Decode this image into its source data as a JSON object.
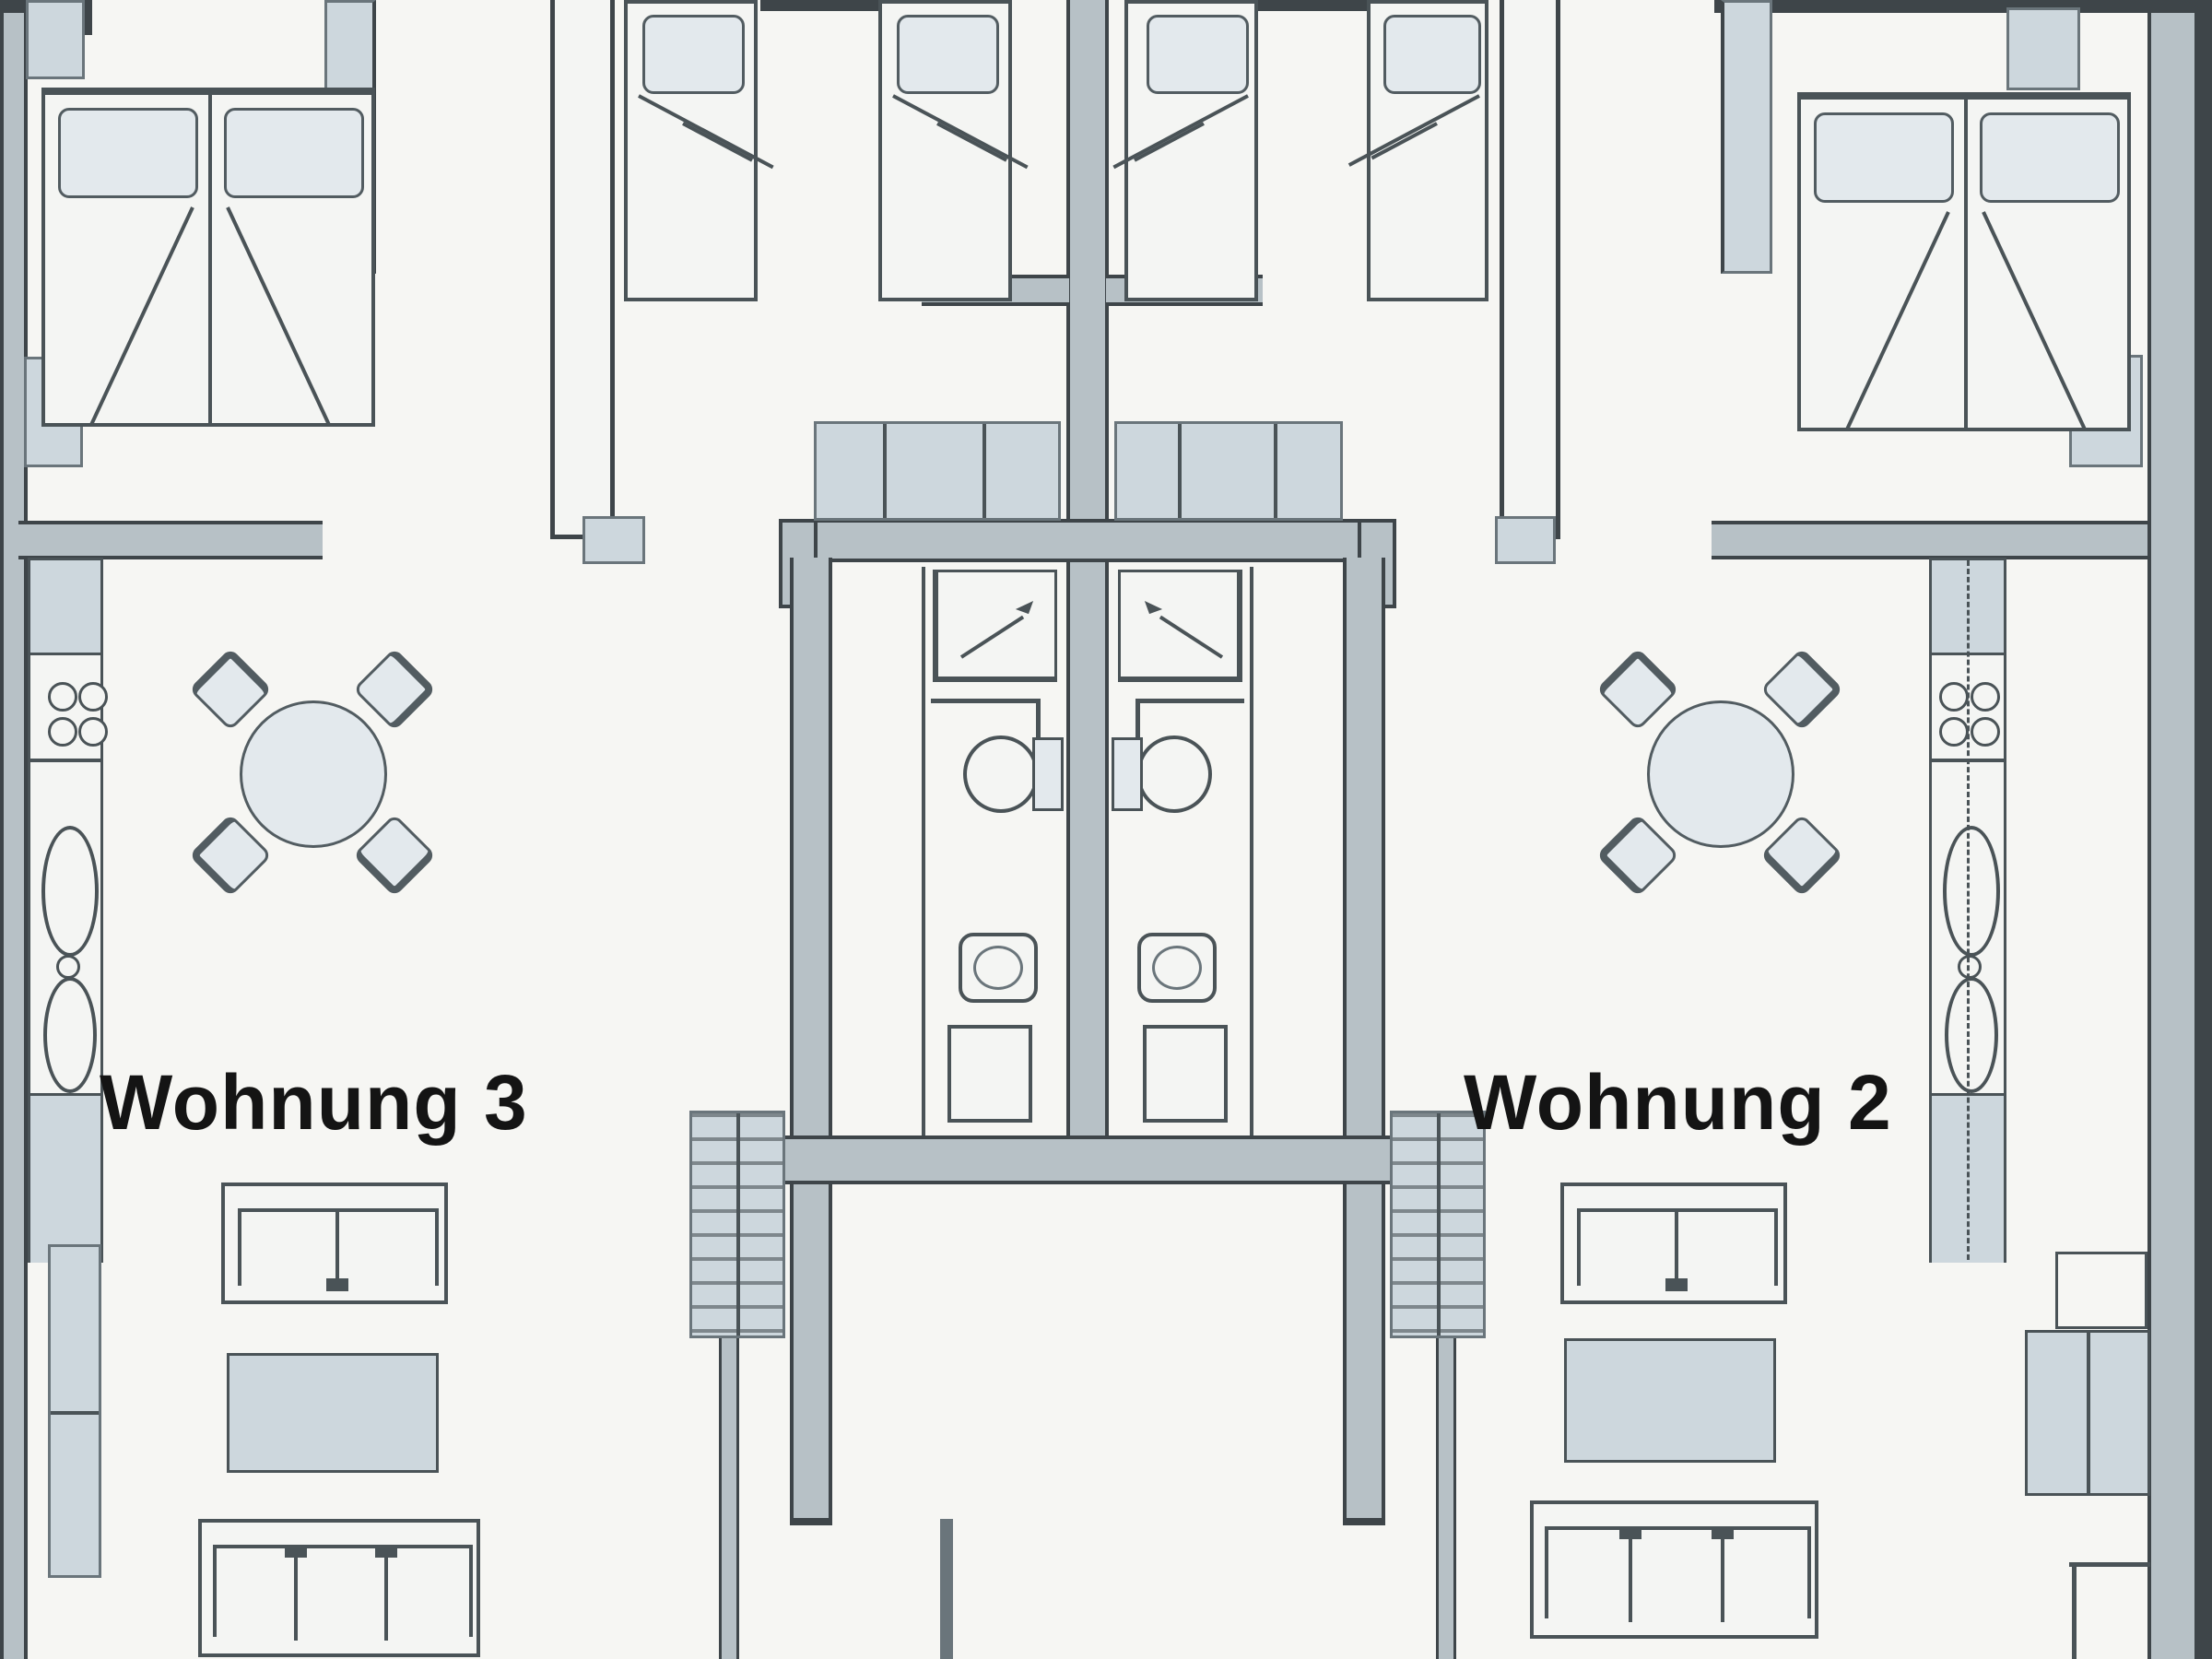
{
  "title": "Apartment floor plan",
  "apartments": [
    {
      "id": "wohnung-3",
      "label": "Wohnung 3"
    },
    {
      "id": "wohnung-2",
      "label": "Wohnung 2"
    }
  ],
  "colors": {
    "bg": "#f6f6f3",
    "white": "#f4f5f3",
    "wall_fill": "#b7c1c6",
    "wall_edge": "#3e4549",
    "line": "#4a5357",
    "furn_fill": "#e3e9ed",
    "furn_edge": "#525c61",
    "shade_fill": "#cdd7dd",
    "shade_edge": "#6a757b",
    "text": "#141414"
  }
}
